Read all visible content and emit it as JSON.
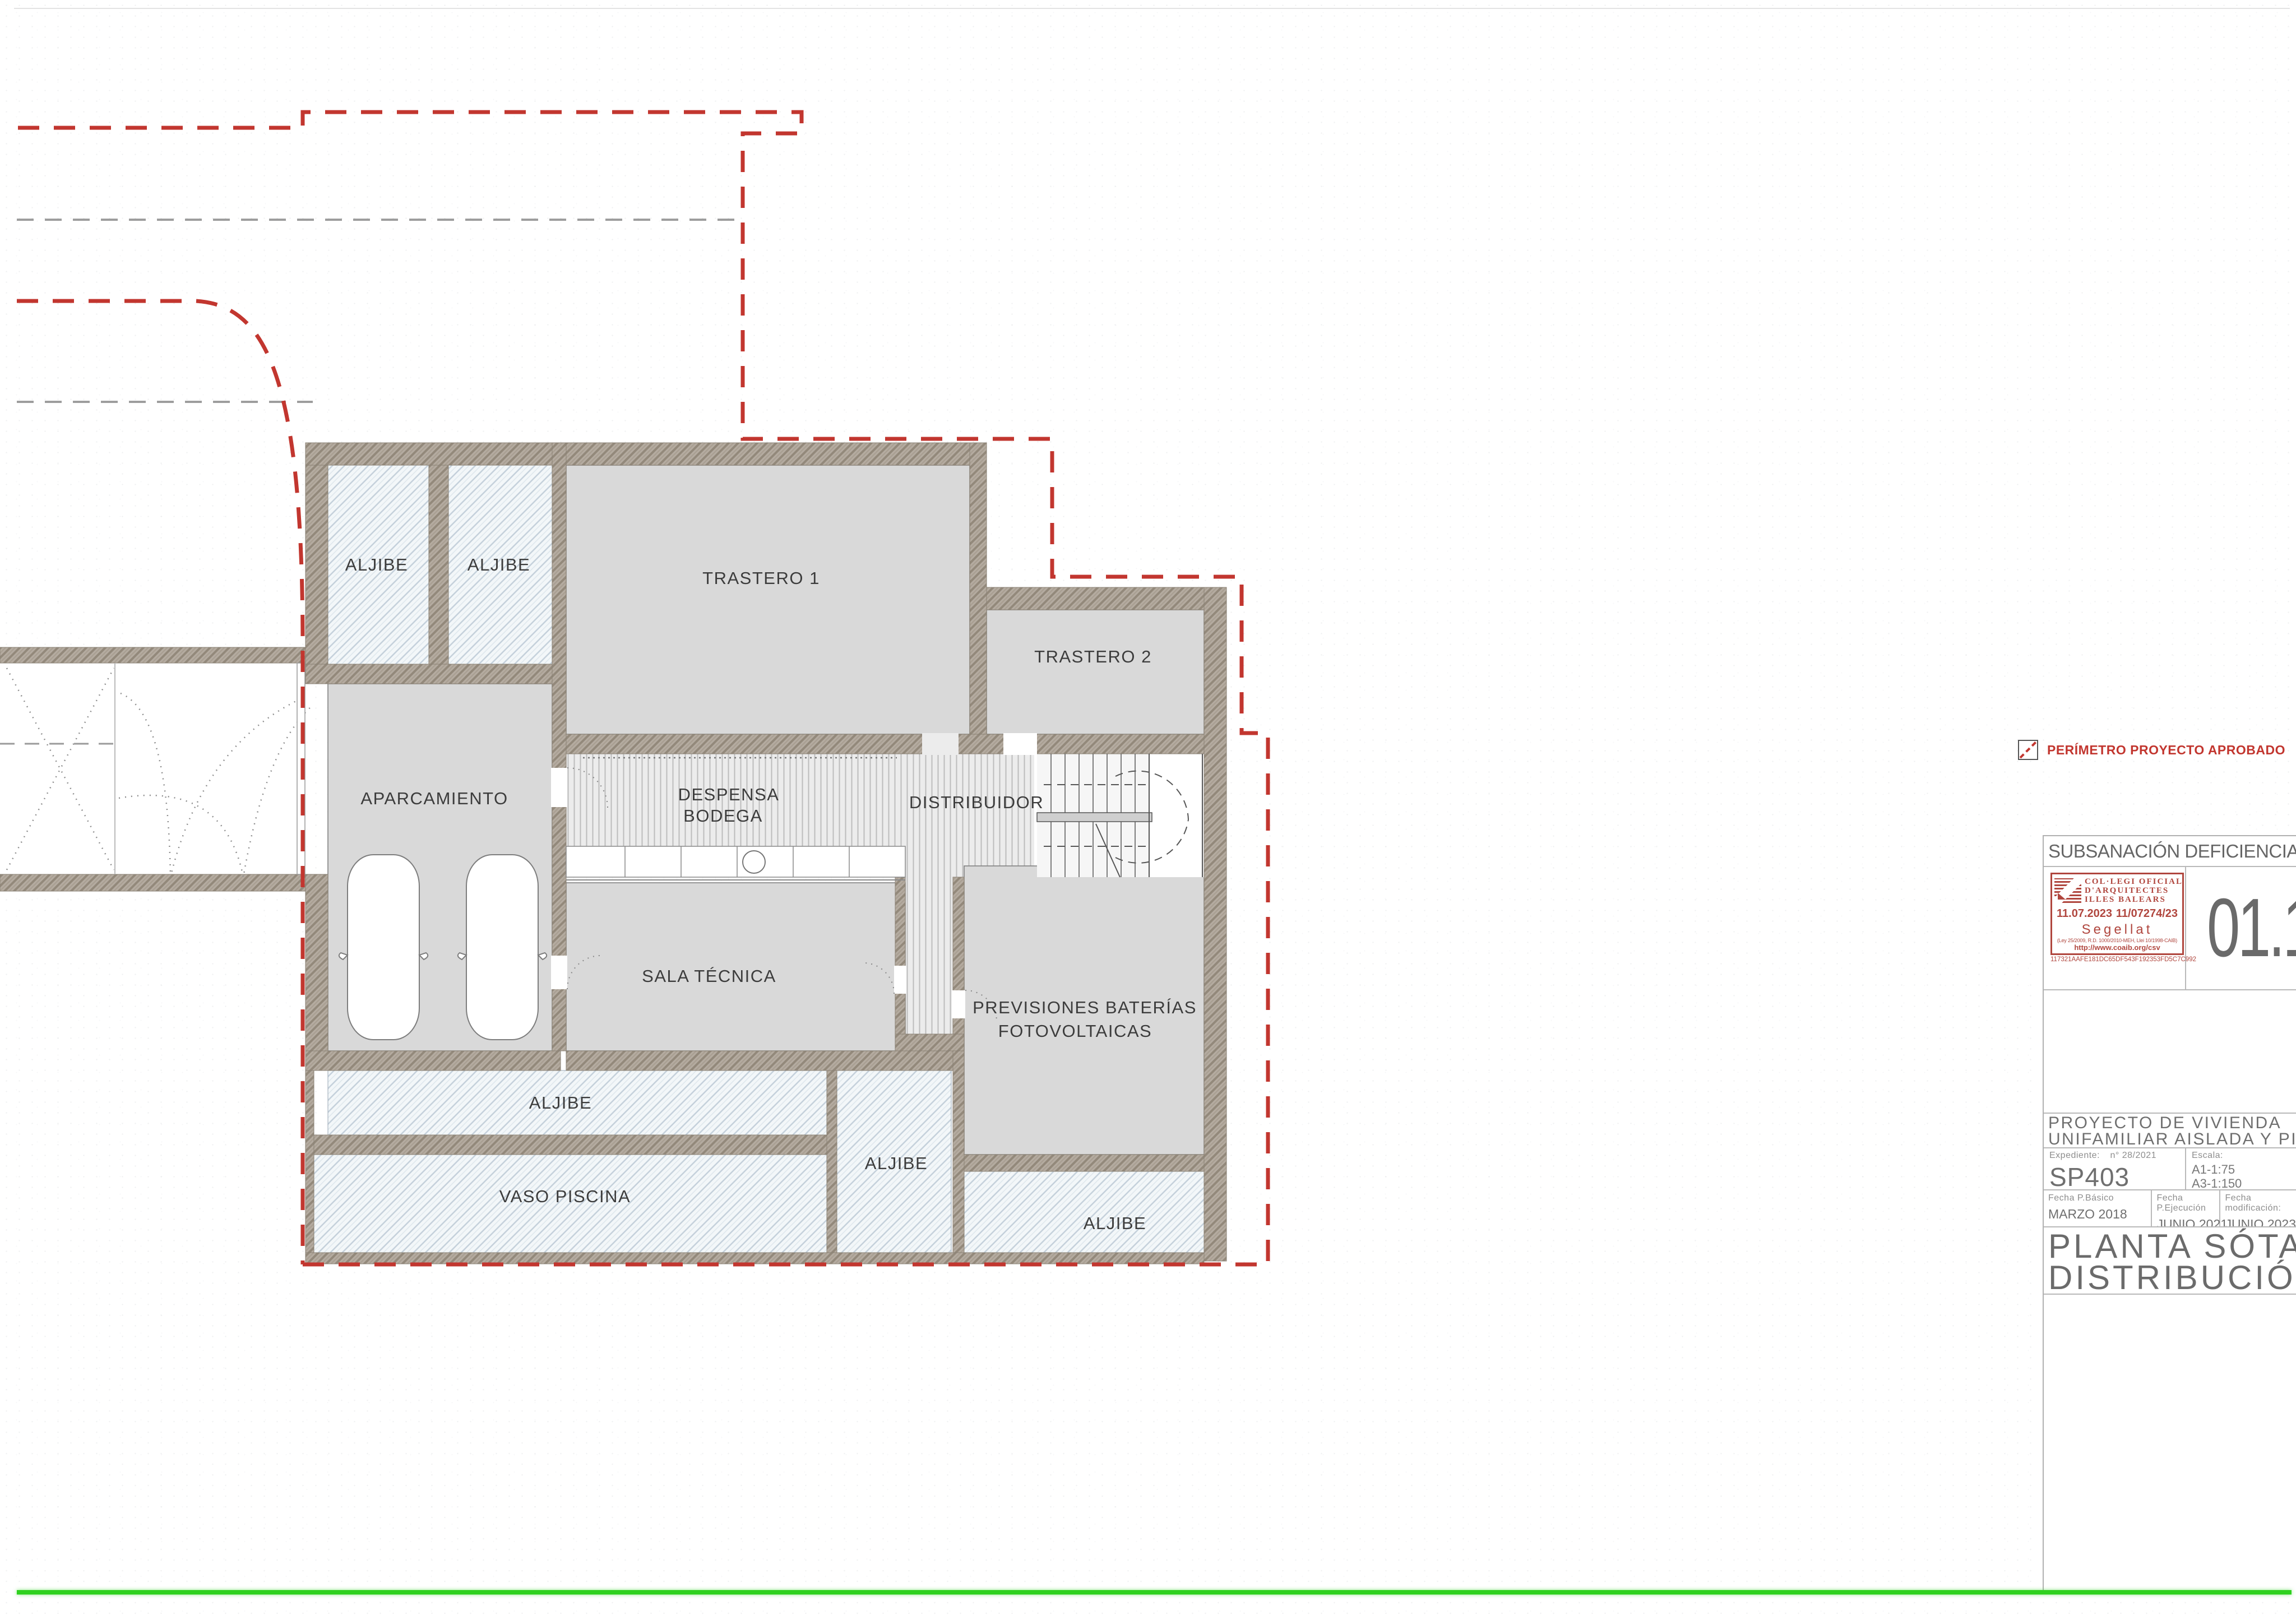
{
  "plan": {
    "rooms": {
      "aljibe_top_1": "ALJIBE",
      "aljibe_top_2": "ALJIBE",
      "trastero_1": "TRASTERO 1",
      "trastero_2": "TRASTERO 2",
      "aparcamiento": "APARCAMIENTO",
      "despensa_line1": "DESPENSA",
      "despensa_line2": "BODEGA",
      "distribuidor": "DISTRIBUIDOR",
      "sala_tecnica": "SALA TÉCNICA",
      "previsiones_line1": "PREVISIONES BATERÍAS",
      "previsiones_line2": "FOTOVOLTAICAS",
      "aljibe_bottom_strip": "ALJIBE",
      "vaso_piscina": "VASO PISCINA",
      "aljibe_mid": "ALJIBE",
      "aljibe_bottom_right": "ALJIBE"
    }
  },
  "legend": {
    "perimeter_label": "PERÍMETRO PROYECTO APROBADO"
  },
  "title_block": {
    "revision_title": "SUBSANACIÓN DEFICIENCIAS DE MTO",
    "sheet_number": "01.1",
    "stamp": {
      "org_line1": "COL·LEGI  OFICIAL",
      "org_line2": "D'ARQUITECTES",
      "org_line3": "ILLES  BALEARS",
      "date": "11.07.2023",
      "file_number": "11/07274/23",
      "sealed": "Segellat",
      "law": "(Ley 25/2009, R.D. 1000/2010-MEH, Llei 10/1998-CAIB)",
      "url": "http://www.coaib.org/csv",
      "hash": "117321AAFE181DC65DF543F192353FD5C7C992"
    },
    "project_title_line1": "PROYECTO DE VIVIENDA",
    "project_title_line2": "UNIFAMILIAR AISLADA Y PISCINA",
    "expediente_label": "Expediente:",
    "expediente_value": "n° 28/2021",
    "project_code": "SP403",
    "escala_label": "Escala:",
    "escala_a1": "A1-1:75",
    "escala_a3": "A3-1:150",
    "fecha_basico_label": "Fecha P.Básico",
    "fecha_basico_value": "MARZO 2018",
    "fecha_ejecucion_label": "Fecha P.Ejecución",
    "fecha_ejecucion_value": "JUNIO 2021",
    "fecha_modificacion_label": "Fecha modificación:",
    "fecha_modificacion_value": "JUNIO 2023",
    "sheet_title_line1": "PLANTA SÓTANO",
    "sheet_title_line2": "DISTRIBUCIÓN"
  },
  "colors": {
    "perimeter_red": "#c2362f",
    "stamp_red": "#b0463e",
    "wall_tone": "#b3aa9e",
    "room_gray": "#d9d9d9",
    "aljibe_blue": "#f2f6f9",
    "green_baseline": "#2fd11f",
    "title_gray": "#6e6e6e"
  }
}
